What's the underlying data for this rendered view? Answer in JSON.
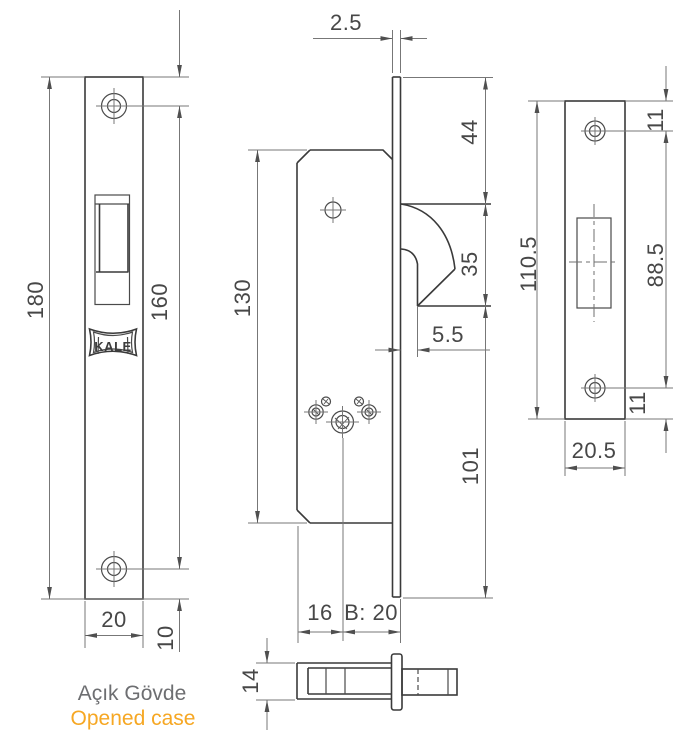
{
  "title": "Kale mortise lock technical drawing",
  "brand": "KALE",
  "caption": {
    "turkish": "Açık Gövde",
    "english": "Opened case"
  },
  "colors": {
    "outline": "#3a3a3a",
    "dimension_line": "#777777",
    "dimension_text": "#474747",
    "caption_gray": "#6d6e71",
    "caption_orange": "#F6A723"
  },
  "views": {
    "faceplate": {
      "label": "front faceplate view",
      "dims": {
        "height": "180",
        "hole_spacing": "160",
        "width": "20",
        "hole_to_bottom": "10"
      }
    },
    "body": {
      "label": "lock body side view",
      "dims": {
        "faceplate_thickness": "2.5",
        "top_to_latch": "44",
        "latch_height": "35",
        "latch_setback": "5.5",
        "body_height": "130",
        "latch_to_bottom": "101",
        "edge_to_spindle": "16",
        "backset": "B: 20"
      }
    },
    "strike": {
      "label": "strike plate view",
      "dims": {
        "height": "110.5",
        "top_to_hole": "11",
        "hole_spacing": "88.5",
        "hole_to_bottom": "11",
        "width": "20.5"
      }
    },
    "side": {
      "label": "case top view",
      "dims": {
        "case_thickness": "14"
      }
    }
  }
}
